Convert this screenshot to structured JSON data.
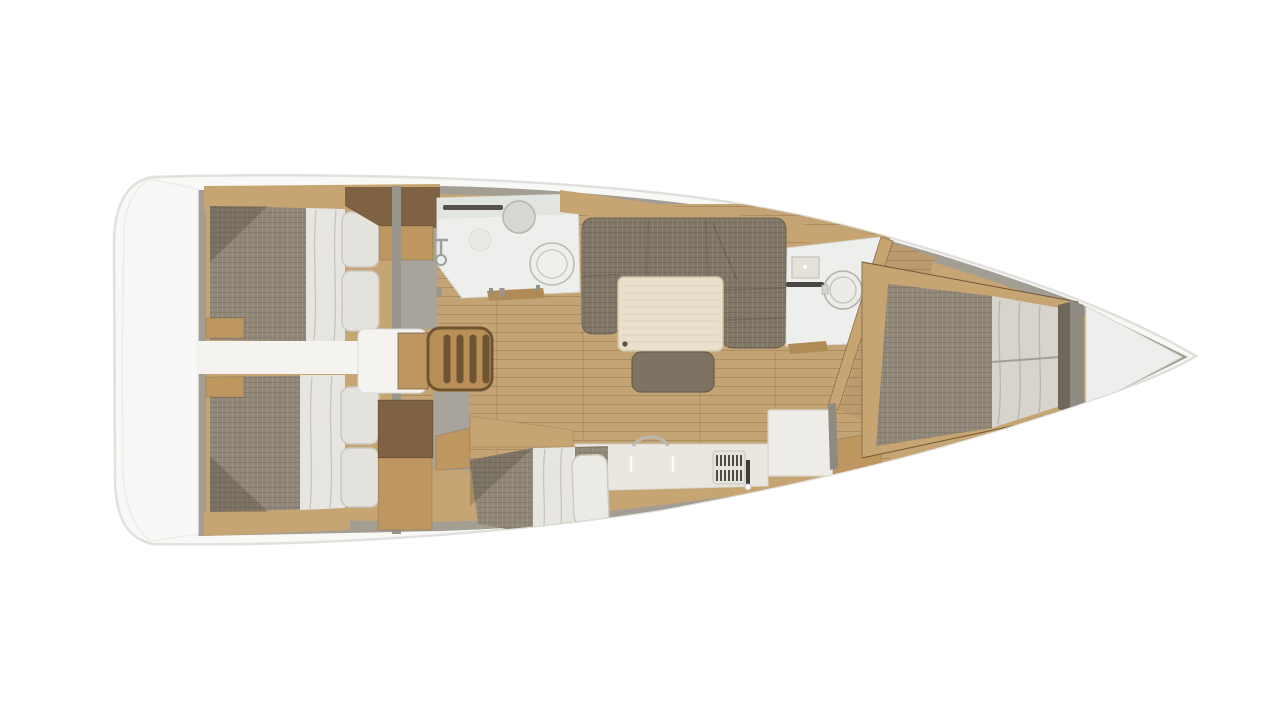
{
  "rooms": {
    "transom": "Stern transom platform",
    "aft_cabin_top": "Aft double cabin (port)",
    "aft_cabin_bottom": "Aft double cabin (starboard)",
    "companionway": "Companionway stairs",
    "aft_head": "Aft bathroom with washbasin, toilet and shower",
    "saloon": "Saloon with U-shaped sofa, table and bench seat",
    "galley": "Galley with sink, stove and refrigerator",
    "quarter_berth": "Quarter berth cabin",
    "forward_head": "Forward bathroom with washbasin and toilet",
    "forward_cabin": "Forward owner cabin with double berth",
    "foredeck": "Bow anchor locker"
  },
  "colors": {
    "page_bg": "#ffffff",
    "hull": "#f8f8f6",
    "hull_edge": "#e0e0dd",
    "wall": "#a29e94",
    "rim": "#c7a572",
    "wood_dark": "#7e6243",
    "wood_mid": "#bd975f",
    "floor": "#c4a475",
    "floor_seam": "#a8895a",
    "mattress": "#8c8272",
    "bedding": "#e7e5e0",
    "bedding_fold": "#c6c4bd",
    "pillow": "#e3e2dc",
    "pillow_edge": "#c9c7c0",
    "sofa": "#7b7161",
    "sofa_seam": "#5d5547",
    "ottoman": "#7d7363",
    "table": "#e8e0cc",
    "table_edge": "#cfc3a6",
    "table_grain": "#dbd1b8",
    "bath": "#edefec",
    "bath_edge": "#d6d8d4",
    "fixture": "#d7d8d4",
    "fixture_edge": "#b2b4af",
    "slot_dark": "#56524b",
    "counter": "#e9e7e0",
    "counter_edge": "#d8d5cc",
    "island": "#edece6",
    "stove_dark": "#4f4a42",
    "stairs_frame": "#6f5433",
    "stairs_tread": "#b98f58",
    "walkway": "#f4f3f0",
    "grey_fill": "#a8a49c",
    "gunwale": "#8f8b82",
    "strip_dark": "#6d675c",
    "foredeck": "#eeeeec",
    "metal": "#b9b9b4",
    "sill": "#b08b56"
  }
}
